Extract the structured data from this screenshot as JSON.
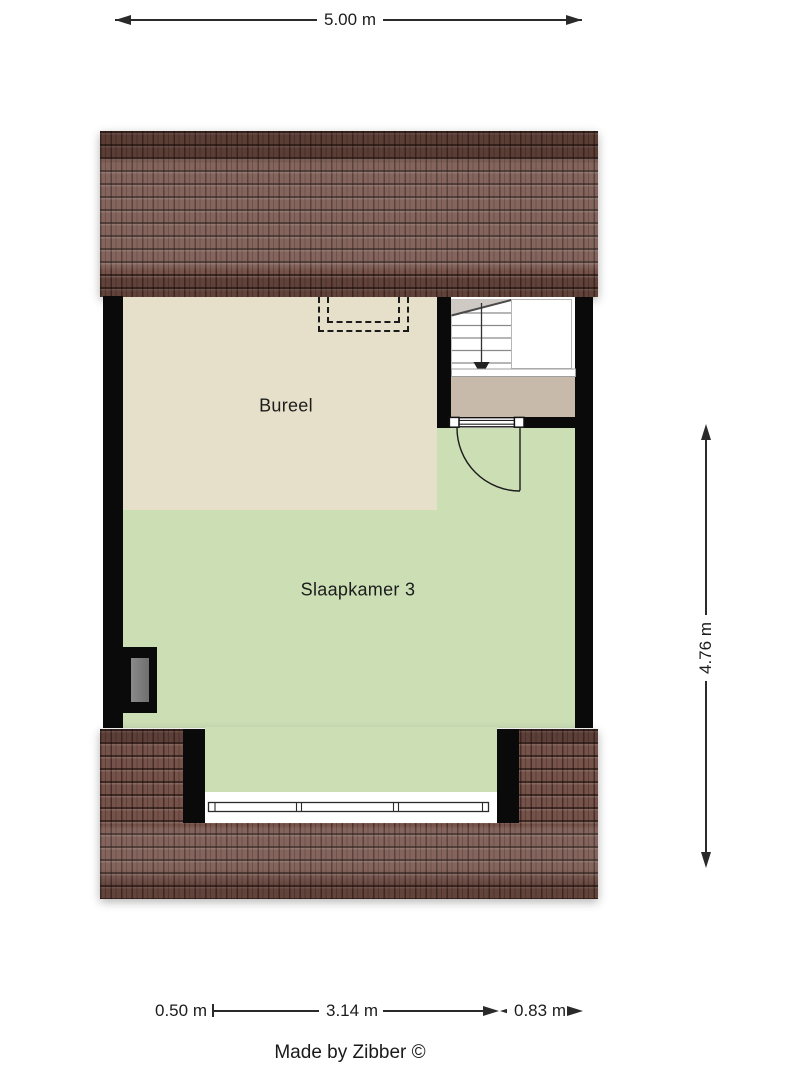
{
  "plan": {
    "rooms": [
      {
        "label": "Bureel"
      },
      {
        "label": "Slaapkamer 3"
      }
    ],
    "stairs": {
      "direction": "down"
    },
    "dimensions": {
      "width_total": "5.00 m",
      "height_right": "4.76 m",
      "bottom": [
        "0.50 m",
        "3.14 m",
        "0.83 m"
      ]
    },
    "credit": "Made by Zibber ©",
    "colors": {
      "room_bureel_floor": "#e6e0ca",
      "room_slaapkamer_floor": "#cbdeb4",
      "landing_floor": "#c7baab",
      "wall": "#0a0a0a",
      "roof_tile": "#76534a",
      "flue_gray": "#7f7f7f",
      "dimension_ink": "#2a2a2a"
    }
  }
}
